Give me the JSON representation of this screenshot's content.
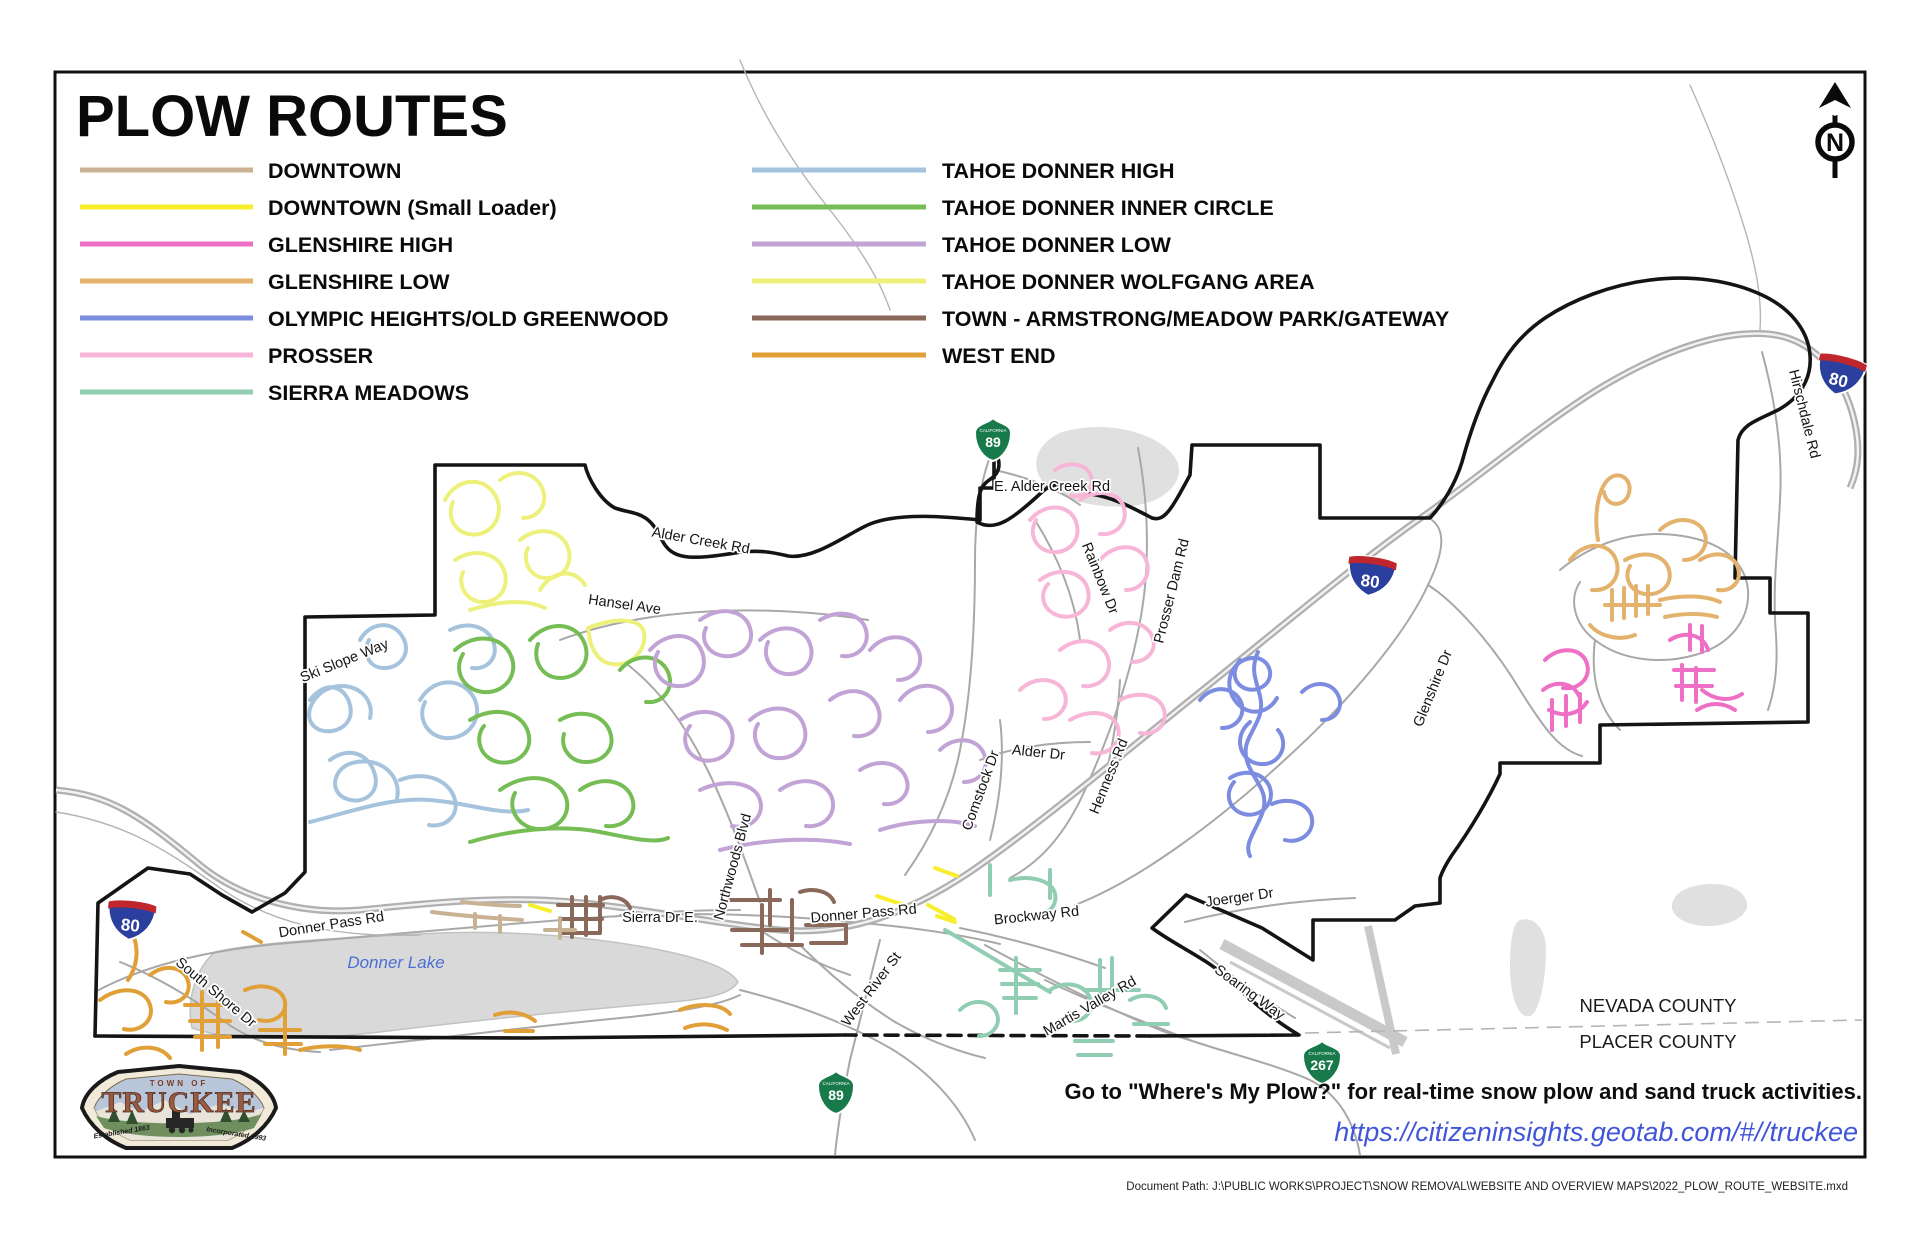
{
  "title": "PLOW ROUTES",
  "routes": {
    "downtown": {
      "label": "DOWNTOWN",
      "color": "#c9b293"
    },
    "downtown_small_loader": {
      "label": "DOWNTOWN (Small Loader)",
      "color": "#f7ee2e"
    },
    "glenshire_high": {
      "label": "GLENSHIRE HIGH",
      "color": "#ee6fc5"
    },
    "glenshire_low": {
      "label": "GLENSHIRE LOW",
      "color": "#e3b26c"
    },
    "olympic_heights": {
      "label": "OLYMPIC HEIGHTS/OLD GREENWOOD",
      "color": "#7c8ce0"
    },
    "prosser": {
      "label": "PROSSER",
      "color": "#f7b6d8"
    },
    "sierra_meadows": {
      "label": "SIERRA MEADOWS",
      "color": "#90cdb2"
    },
    "tahoe_donner_high": {
      "label": "TAHOE DONNER HIGH",
      "color": "#a6c3dd"
    },
    "tahoe_donner_inner": {
      "label": "TAHOE DONNER INNER CIRCLE",
      "color": "#77bd55"
    },
    "tahoe_donner_low": {
      "label": "TAHOE DONNER LOW",
      "color": "#c2a3d6"
    },
    "tahoe_donner_wolfgang": {
      "label": "TAHOE DONNER WOLFGANG AREA",
      "color": "#eef07c"
    },
    "town_armstrong": {
      "label": "TOWN - ARMSTRONG/MEADOW PARK/GATEWAY",
      "color": "#8a695a"
    },
    "west_end": {
      "label": "WEST END",
      "color": "#e0a037"
    }
  },
  "map": {
    "lake_label": "Donner Lake",
    "road_labels": [
      "Alder Creek Rd",
      "E. Alder Creek Rd",
      "Rainbow Dr",
      "Prosser Dam Rd",
      "Glenshire Dr",
      "Alder Dr",
      "Henness Rd",
      "Comstock Dr",
      "Hansel Ave",
      "Ski Slope Way",
      "Northwoods Blvd",
      "Donner Pass Rd",
      "Donner Pass Rd",
      "Sierra Dr E.",
      "Brockway Rd",
      "West River St",
      "Martis Valley Rd",
      "Joerger Dr",
      "Soaring Way",
      "South Shore Dr",
      "Hirschdale Rd"
    ],
    "counties": {
      "north": "NEVADA COUNTY",
      "south": "PLACER COUNTY"
    },
    "shields": {
      "interstate": "80",
      "ca89": "89",
      "ca267": "267",
      "california": "CALIFORNIA"
    }
  },
  "compass": {
    "letter": "N"
  },
  "notes": {
    "plow_text": "Go to \"Where's My Plow?\" for real-time snow plow and sand truck activities.",
    "url": "https://citizeninsights.geotab.com/#//truckee"
  },
  "logo": {
    "town_of": "TOWN OF",
    "name": "TRUCKEE",
    "established": "Established 1863",
    "incorporated": "Incorporated 1993"
  },
  "footer": {
    "document_path": "Document Path: J:\\PUBLIC WORKS\\PROJECT\\SNOW REMOVAL\\WEBSITE AND OVERVIEW MAPS\\2022_PLOW_ROUTE_WEBSITE.mxd"
  }
}
